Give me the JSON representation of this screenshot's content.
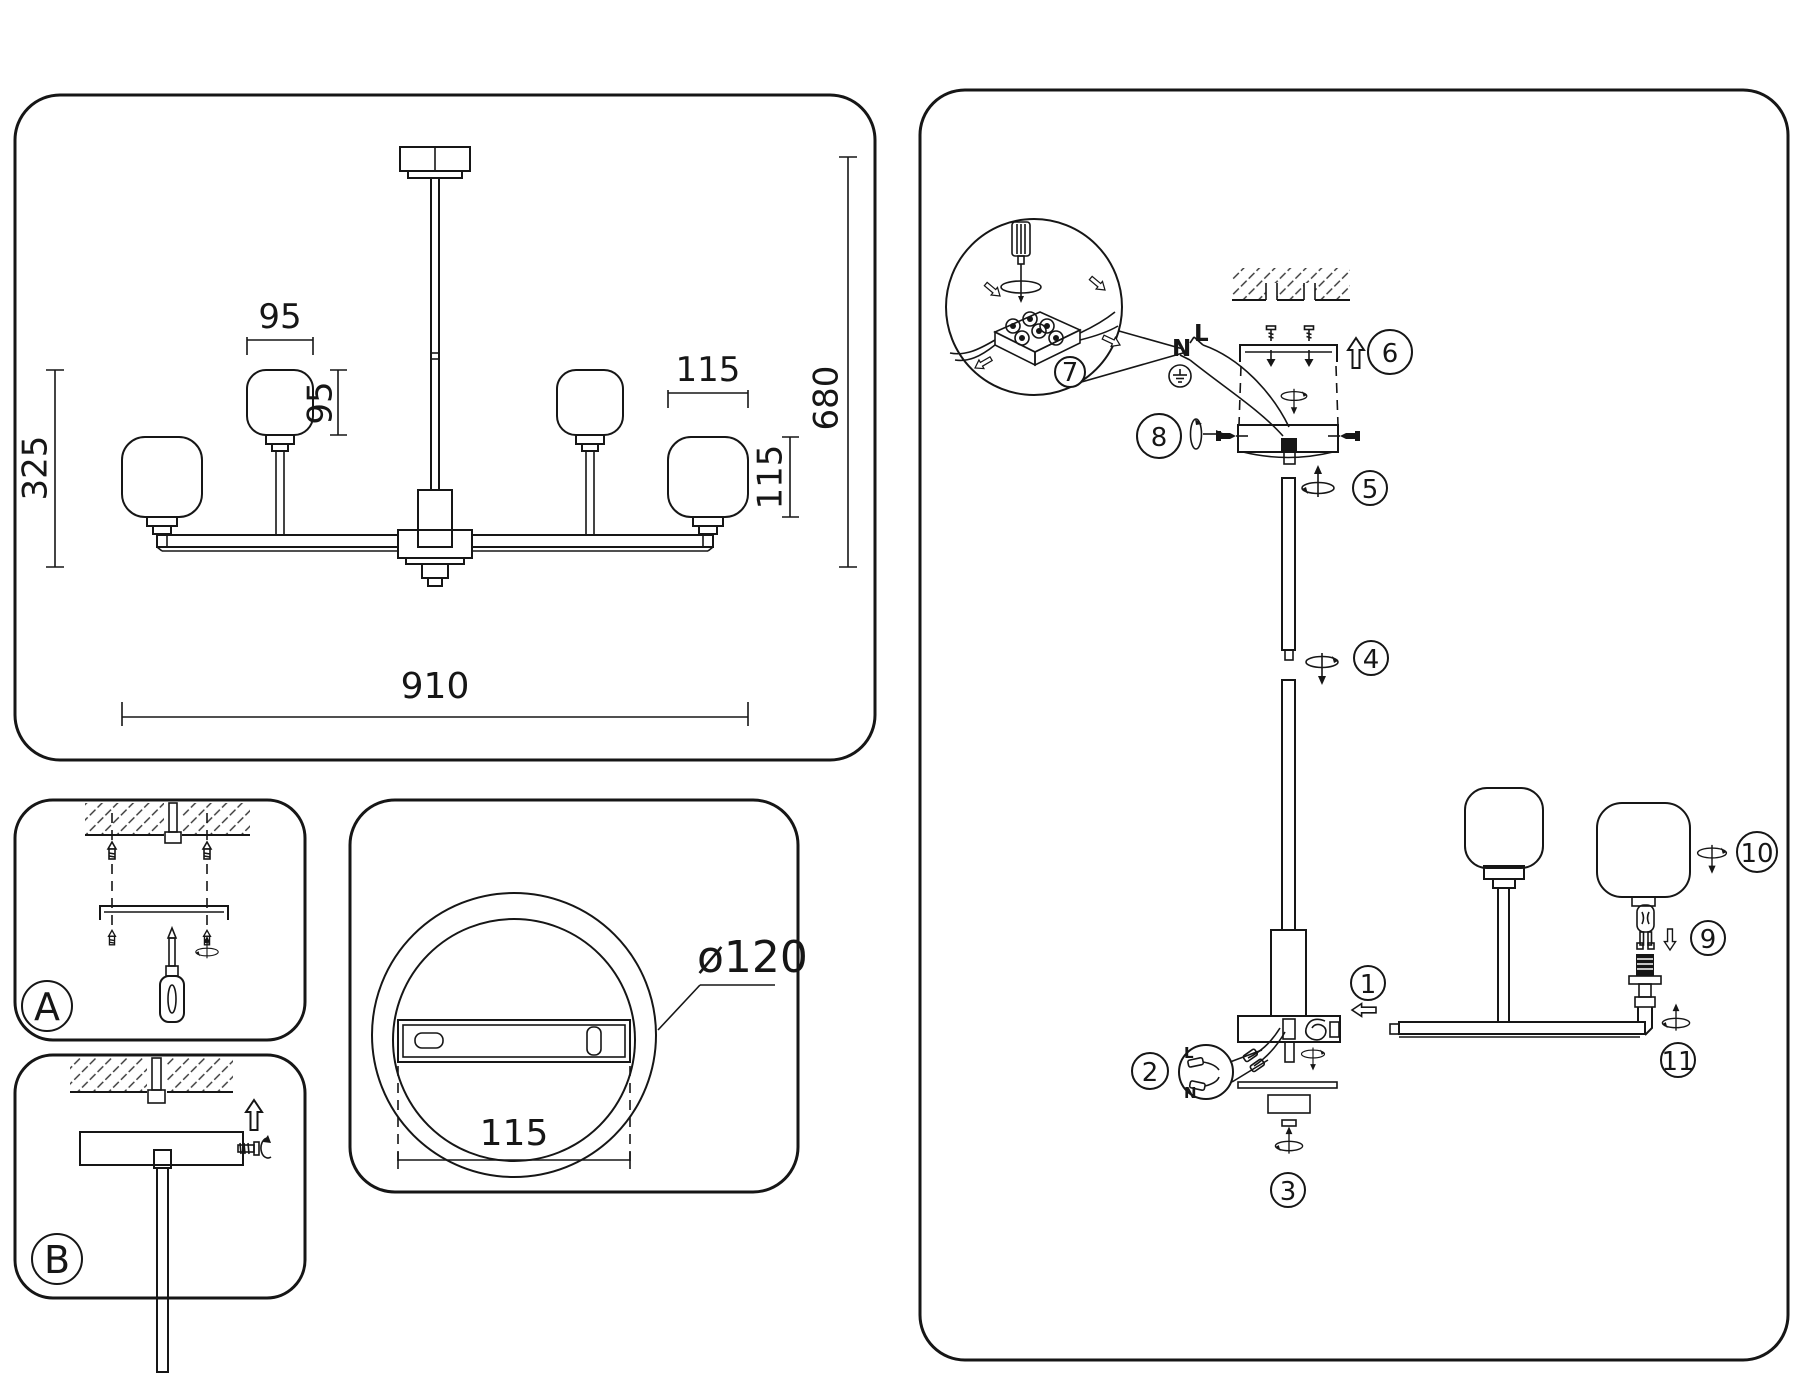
{
  "drawing": {
    "overall_width": "910",
    "overall_height": "680",
    "drop_height": "325",
    "small_shade_width": "95",
    "small_shade_height": "95",
    "large_shade_width": "115",
    "large_shade_height": "115"
  },
  "canopy_detail": {
    "diameter": "ø120",
    "hole_spacing": "115"
  },
  "mounting": {
    "method_a": "A",
    "method_b": "B"
  },
  "assembly": {
    "terminal": {
      "neutral": "N",
      "live": "L"
    },
    "connectors": {
      "live": "L",
      "neutral": "N"
    },
    "steps": {
      "s1": "1",
      "s2": "2",
      "s3": "3",
      "s4": "4",
      "s5": "5",
      "s6": "6",
      "s7": "7",
      "s8": "8",
      "s9": "9",
      "s10": "10",
      "s11": "11"
    }
  }
}
